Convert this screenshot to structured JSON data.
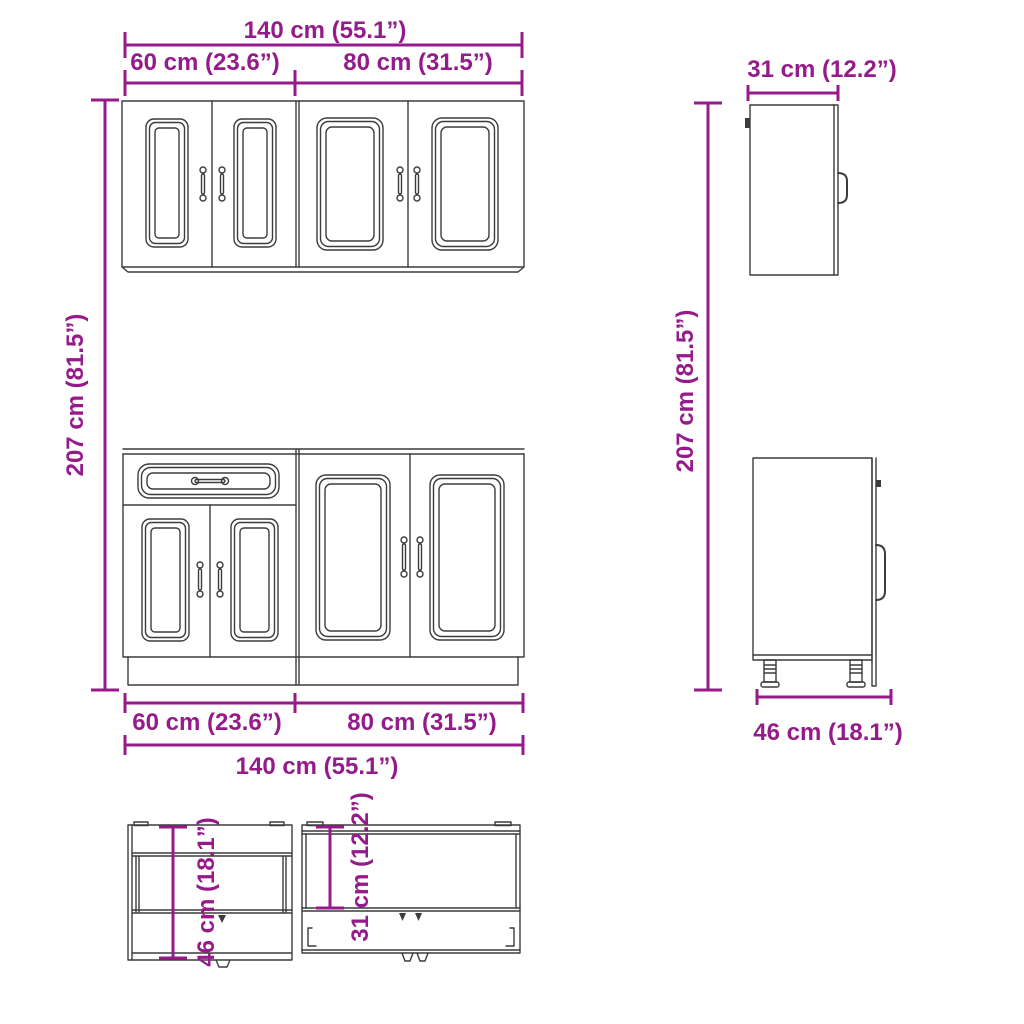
{
  "colors": {
    "dimension_accent": "#951b8b",
    "drawing_line": "#3c3c3c",
    "background": "#ffffff"
  },
  "labels": {
    "top_total_width": "140 cm (55.1”)",
    "top_left_width": "60 cm (23.6”)",
    "top_right_width": "80 cm (31.5”)",
    "left_total_height": "207 cm (81.5”)",
    "wall_cabinet_depth": "31 cm (12.2”)",
    "right_total_height": "207 cm (81.5”)",
    "bottom_left_width": "60 cm (23.6”)",
    "bottom_right_width": "80 cm (31.5”)",
    "bottom_total_width": "140 cm (55.1”)",
    "base_cabinet_depth": "46 cm (18.1”)",
    "top_view_base_depth": "46 cm (18.1”)",
    "top_view_wall_depth": "31 cm (12.2”)"
  }
}
